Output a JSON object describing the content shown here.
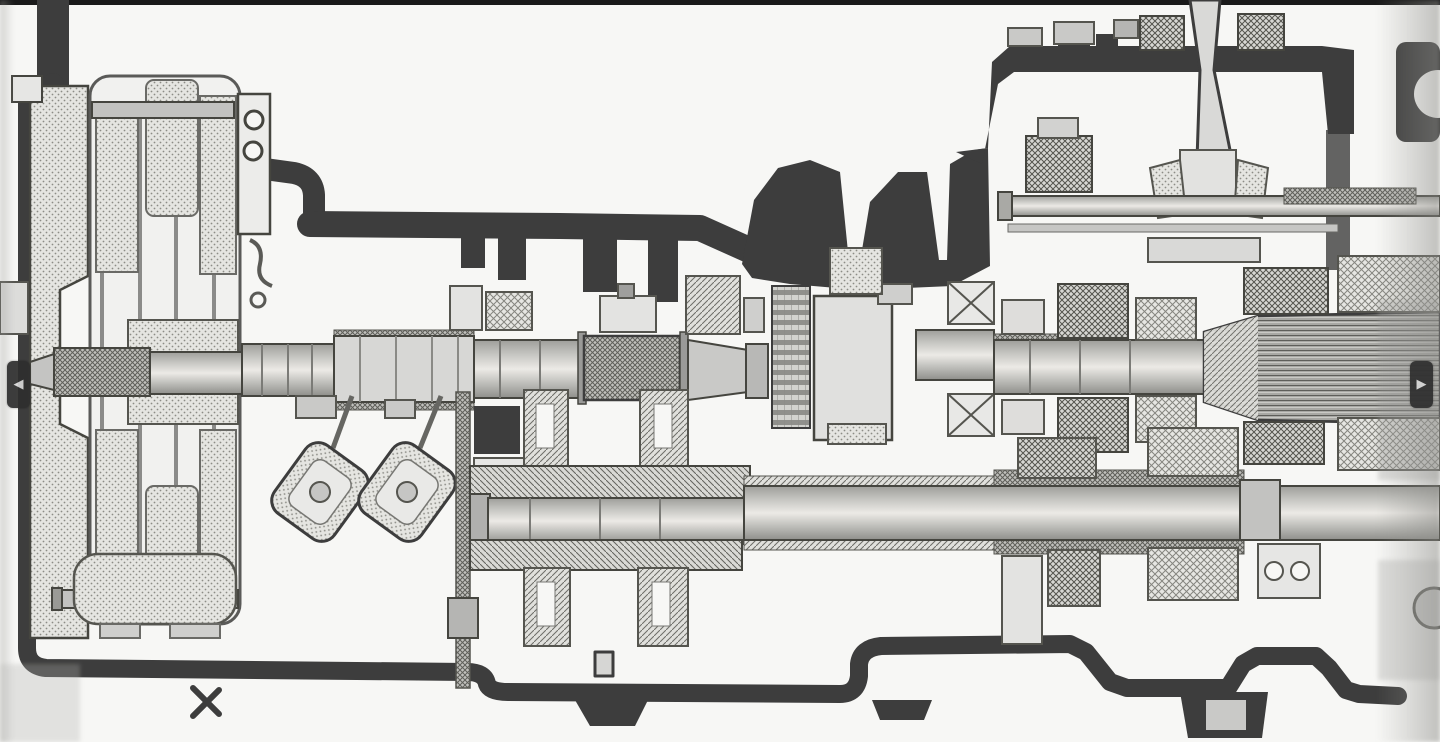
{
  "viewer": {
    "prev_button": {
      "glyph": "◀"
    },
    "next_button": {
      "glyph": "▶"
    },
    "button_bg": "#2f2f2f",
    "button_fg": "#d6d6d6"
  },
  "canvas": {
    "paper": "#f7f7f5",
    "ink": "#3d3d3d",
    "top_border": "#1a1a1a",
    "midtone": "#c6c6c2"
  }
}
